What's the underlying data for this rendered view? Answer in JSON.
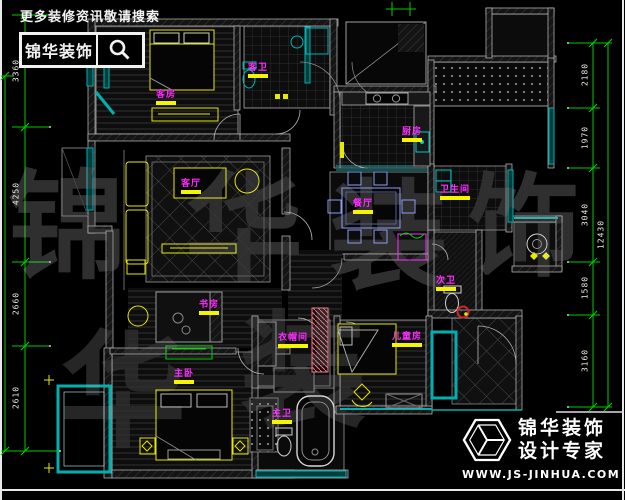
{
  "header": {
    "search_text": "更多装修资讯敬请搜索",
    "brand": "锦华装饰"
  },
  "footer": {
    "brand_line1": "锦华装饰",
    "brand_line2": "设计专家",
    "website": "WWW.JS-JINHUA.COM"
  },
  "watermark": {
    "chars": [
      "锦",
      "华",
      "装",
      "饰",
      "华",
      "装"
    ]
  },
  "rooms": [
    {
      "id": "guest-bedroom",
      "label": "客房"
    },
    {
      "id": "guest-bathroom",
      "label": "客卫"
    },
    {
      "id": "kitchen",
      "label": "厨房"
    },
    {
      "id": "living-room",
      "label": "客厅"
    },
    {
      "id": "dining-room",
      "label": "餐厅"
    },
    {
      "id": "bathroom",
      "label": "卫生间"
    },
    {
      "id": "second-bathroom",
      "label": "次卫"
    },
    {
      "id": "study",
      "label": "书房"
    },
    {
      "id": "master-bedroom",
      "label": "主卧"
    },
    {
      "id": "cloakroom",
      "label": "衣帽间"
    },
    {
      "id": "master-bathroom",
      "label": "主卫"
    },
    {
      "id": "kids-room",
      "label": "儿童房"
    }
  ],
  "dimensions": {
    "left": [
      {
        "value": "3360"
      },
      {
        "value": "4250"
      },
      {
        "value": "2660"
      },
      {
        "value": "2610"
      }
    ],
    "right": [
      {
        "value": "2180"
      },
      {
        "value": "1970"
      },
      {
        "value": "3040"
      },
      {
        "value": "1580"
      },
      {
        "value": "3160"
      }
    ],
    "right_overall": {
      "value": "12430"
    }
  },
  "colors": {
    "wall_line": "#c8c8c8",
    "window_teal": "#00b0b0",
    "furniture_yellow": "#e8e800",
    "label_magenta": "#ff2bff",
    "label_underline": "#f5f500",
    "dimension_green": "#00cc00",
    "accent_red": "#cc2626",
    "dining_blue": "#8c9cf0",
    "piano_pink": "#e87888"
  }
}
